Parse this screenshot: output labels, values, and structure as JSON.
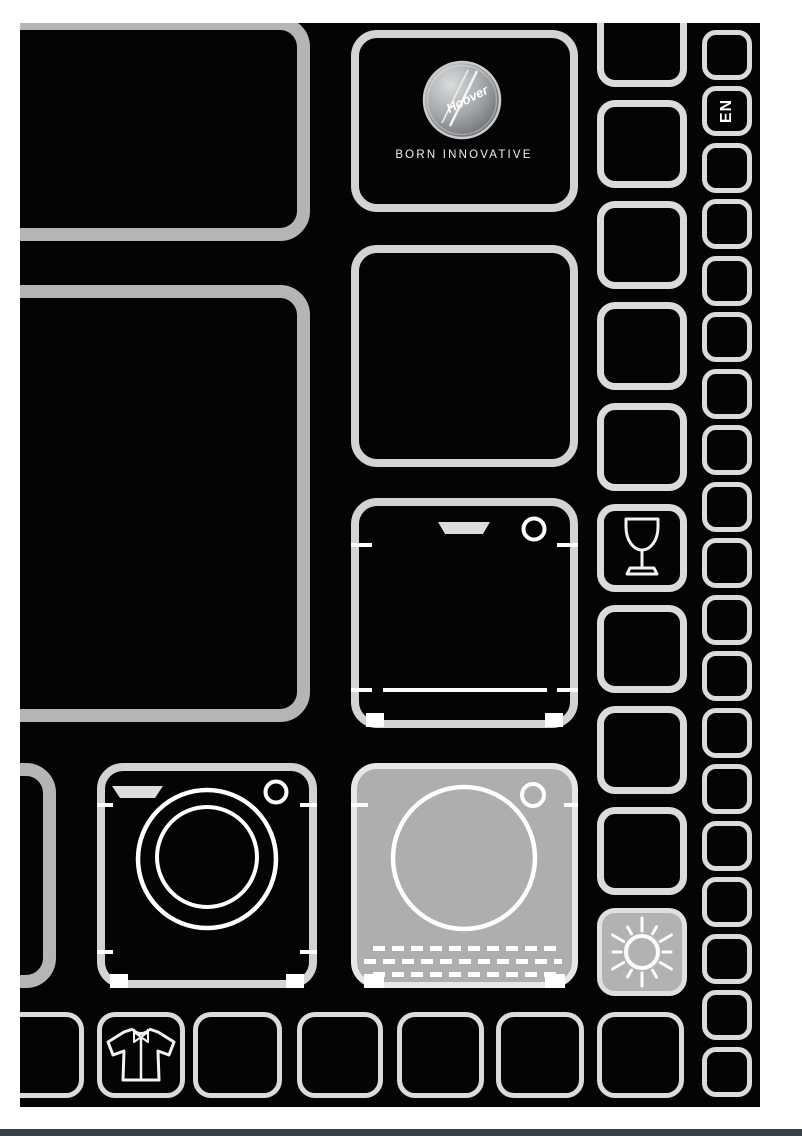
{
  "cover": {
    "brand": {
      "logo_text": "Hoover",
      "tagline": "BORN INNOVATIVE"
    },
    "language_badge": "EN",
    "icons": [
      "hoover-logo-badge",
      "dishwasher-icon",
      "washing-machine-icon",
      "tumble-dryer-icon",
      "wine-glass-icon",
      "sun-icon",
      "shirt-icon"
    ],
    "colors": {
      "background": "#040404",
      "page_margin": "#ffffff",
      "cell_border_heavy": "#b3b5b7",
      "cell_border_medium": "#d2d3d4",
      "cell_border_light": "#dadbdc",
      "filled_cell": "#acaeb0",
      "icon_stroke": "#ffffff",
      "bottom_bar": "#3a3e45"
    }
  }
}
